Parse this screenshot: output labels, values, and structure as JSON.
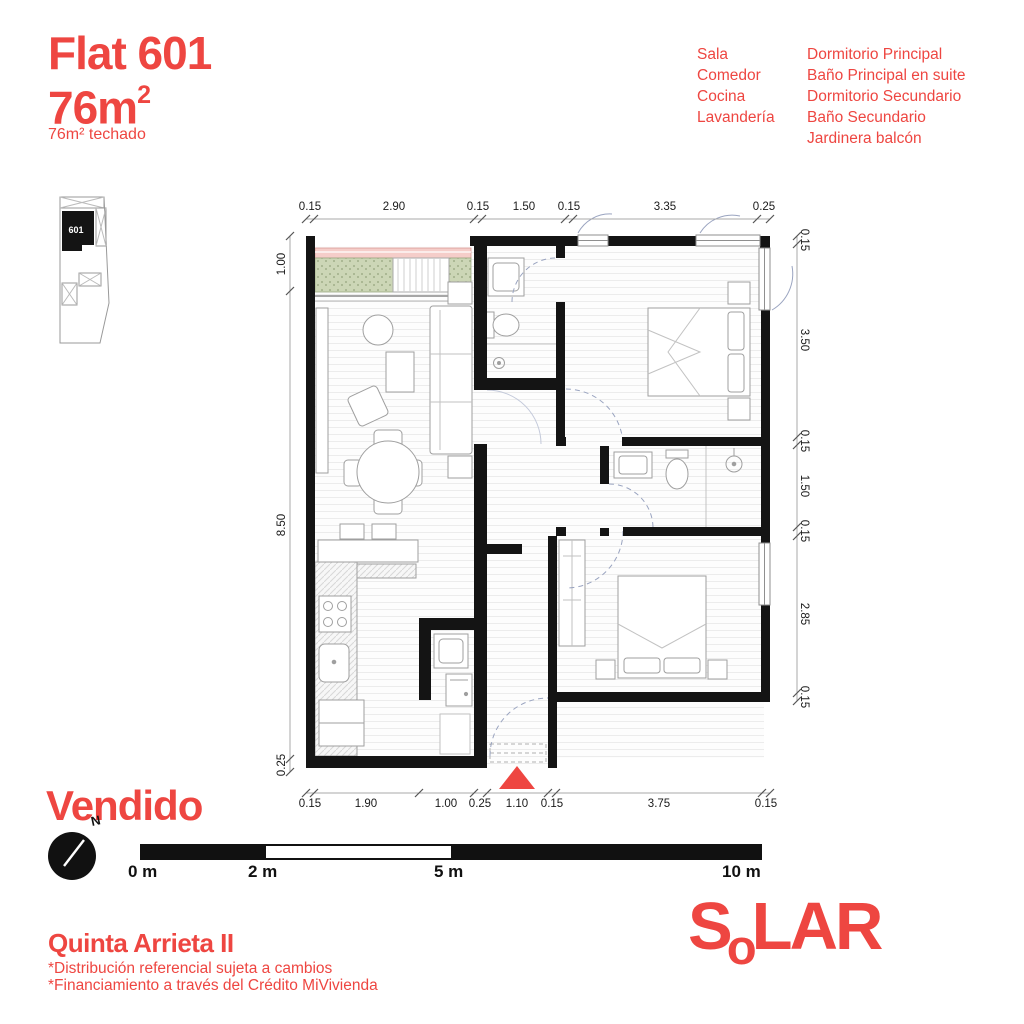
{
  "header": {
    "title": "Flat 601",
    "area_main": "76m",
    "area_sup": "2",
    "area_sub": "76m²  techado"
  },
  "rooms": {
    "col1": [
      "Sala",
      "Comedor",
      "Cocina",
      "Lavandería"
    ],
    "col2": [
      "Dormitorio Principal",
      "Baño Principal en suite",
      "Dormitorio Secundario",
      "Baño Secundario",
      "Jardinera balcón"
    ]
  },
  "keyplan": {
    "unit": "601"
  },
  "plan": {
    "dims": {
      "top": [
        "0.15",
        "2.90",
        "0.15",
        "1.50",
        "0.15",
        "3.35",
        "0.25"
      ],
      "left": [
        "1.00",
        "8.50",
        "0.25"
      ],
      "right": [
        "0.15",
        "3.50",
        "0.15",
        "1.50",
        "0.15",
        "2.85",
        "0.15"
      ],
      "bottom": [
        "0.15",
        "1.90",
        "1.00",
        "0.25",
        "1.10",
        "0.15",
        "3.75",
        "0.15"
      ]
    }
  },
  "status": {
    "label": "Vendido"
  },
  "compass": {
    "north": "N"
  },
  "scalebar": {
    "labels": [
      "0 m",
      "2 m",
      "5 m",
      "10 m"
    ]
  },
  "footer": {
    "project": "Quinta Arrieta II",
    "disclaimer1": "*Distribución referencial sujeta a cambios",
    "disclaimer2": "*Financiamiento a través del Crédito MiVivienda"
  },
  "logo": {
    "s": "S",
    "o": "o",
    "lar": "LAR"
  },
  "colors": {
    "accent": "#EE4641",
    "wall": "#141414",
    "planter_green": "#CCD6B6",
    "planter_pink": "#F5CDC9"
  }
}
